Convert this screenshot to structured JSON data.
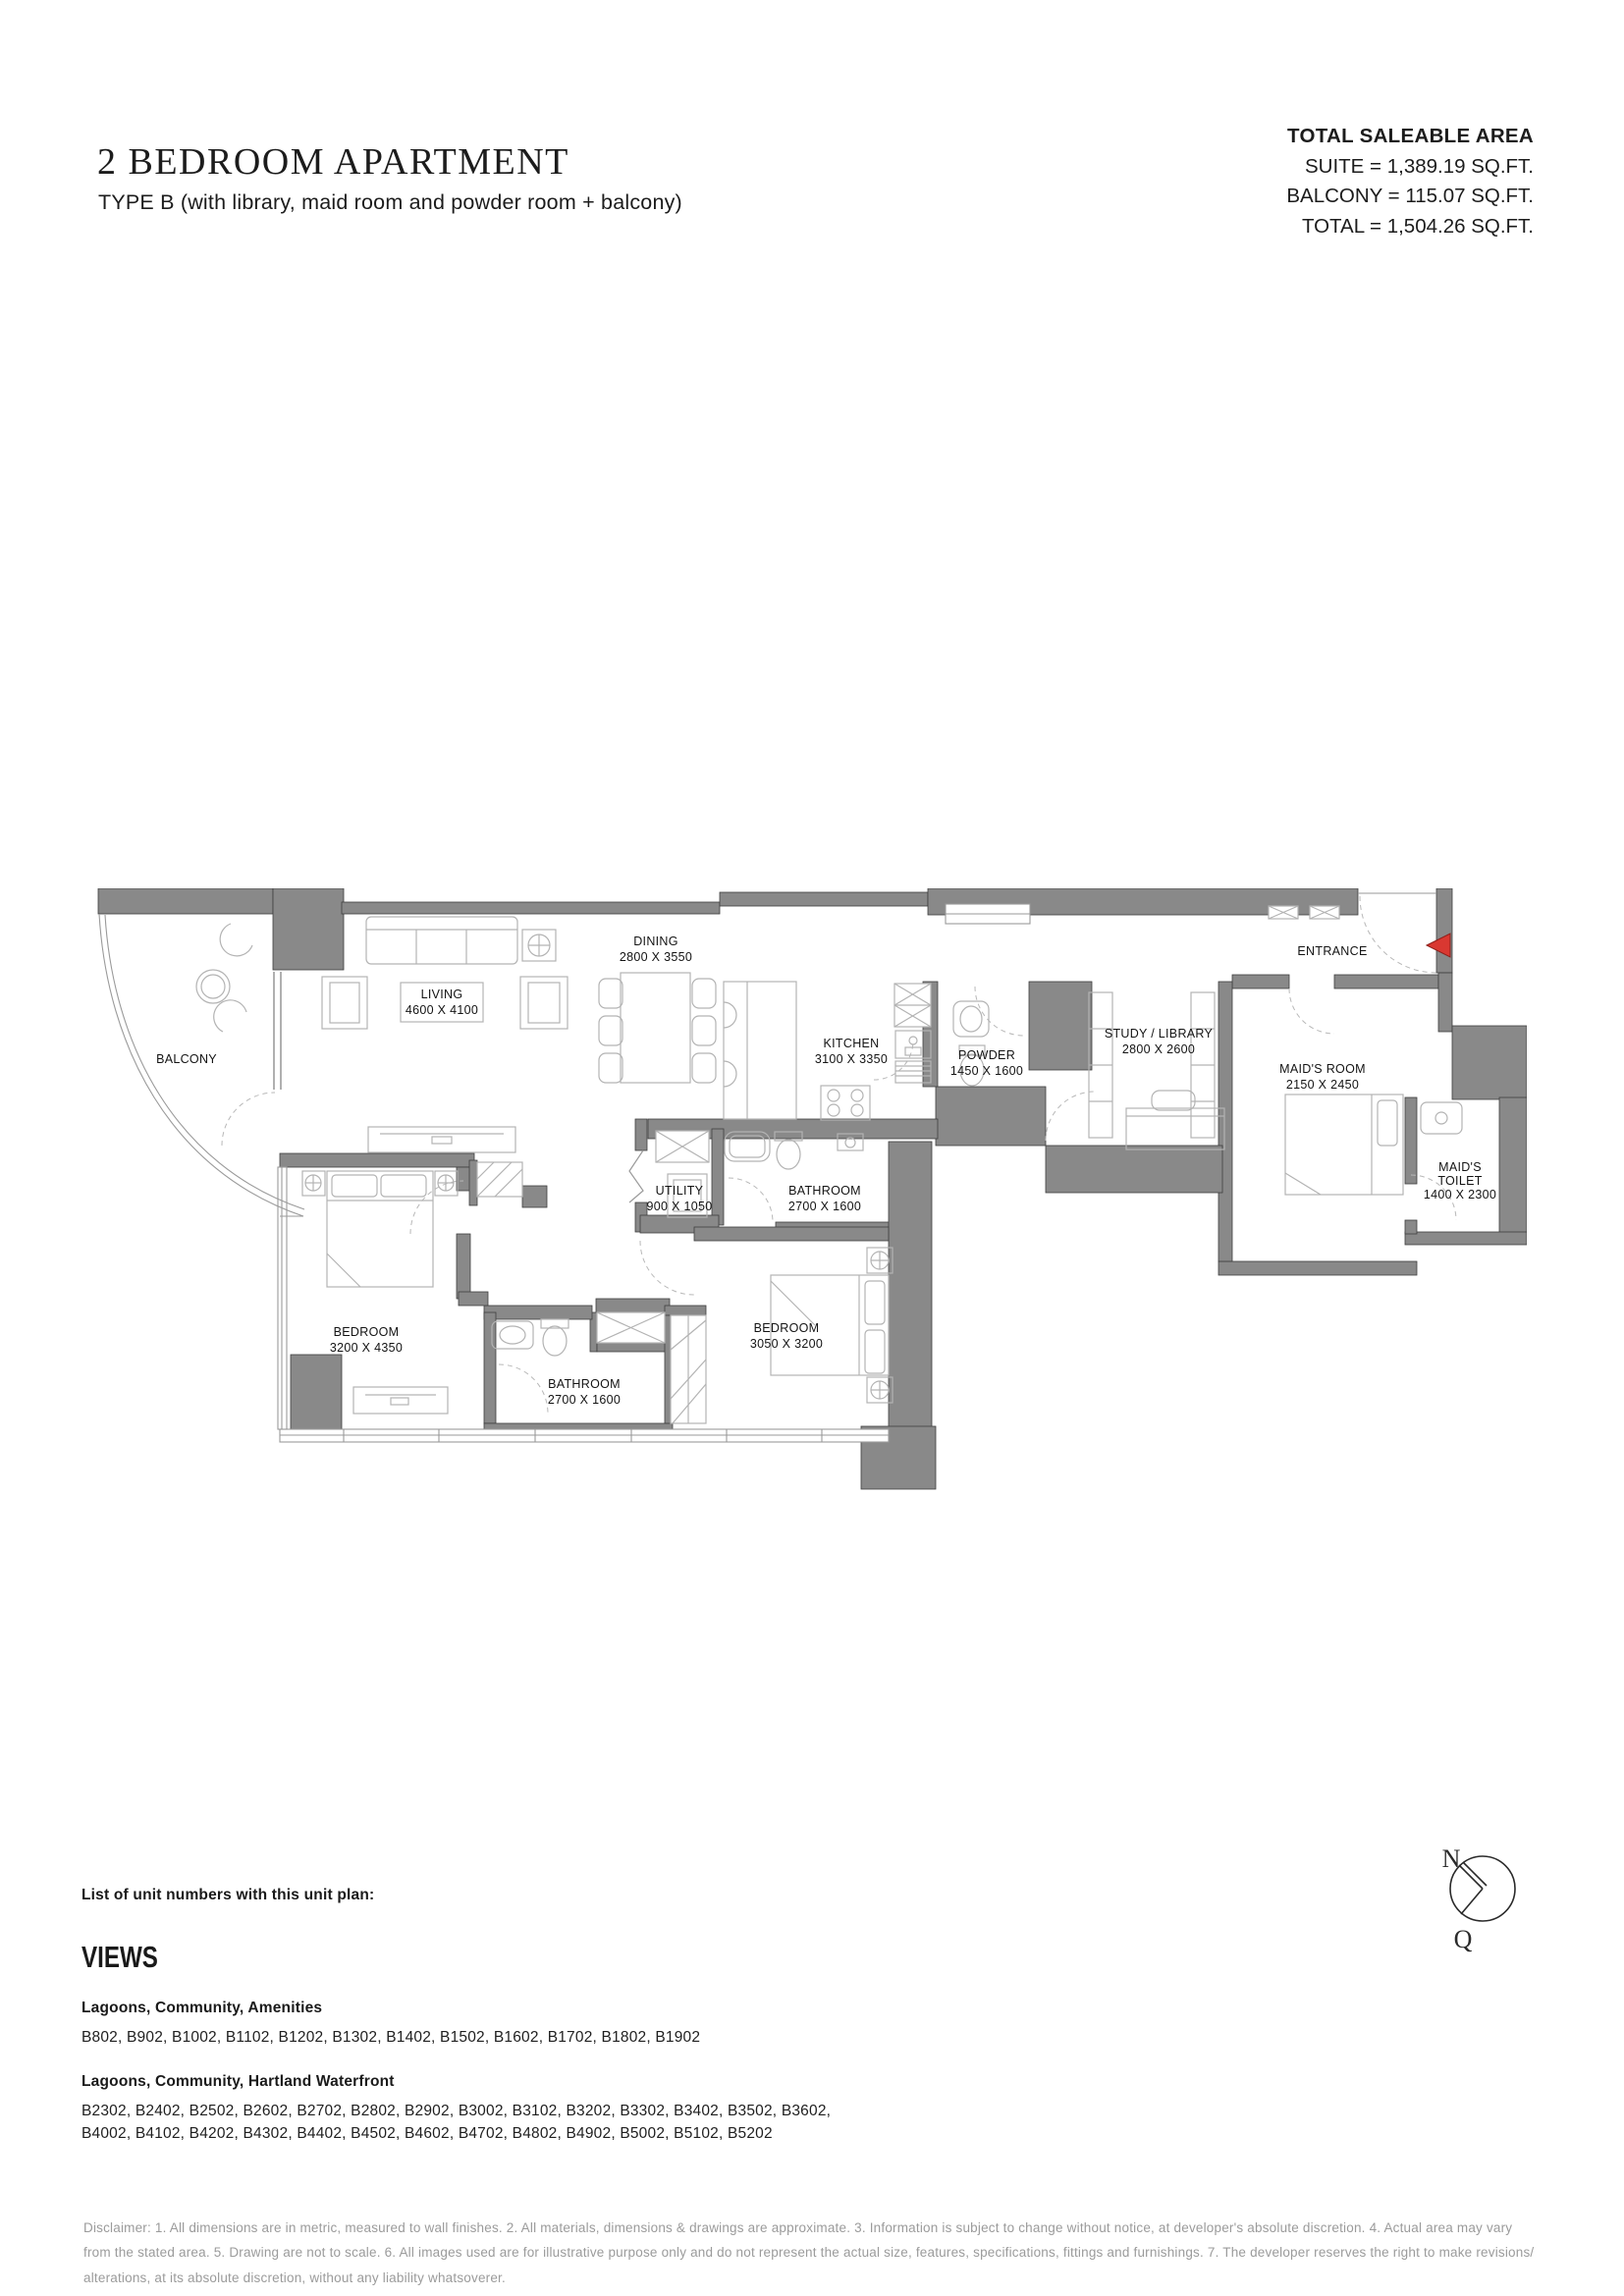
{
  "header": {
    "title": "2 BEDROOM APARTMENT",
    "subtitle": "TYPE B (with library, maid room and powder room + balcony)",
    "area": {
      "heading": "TOTAL SALEABLE AREA",
      "lines": [
        "SUITE = 1,389.19 SQ.FT.",
        "BALCONY = 115.07 SQ.FT.",
        "TOTAL = 1,504.26 SQ.FT."
      ]
    }
  },
  "plan": {
    "rooms": {
      "balcony": {
        "name": "BALCONY"
      },
      "living": {
        "name": "LIVING",
        "dims": "4600 X 4100"
      },
      "dining": {
        "name": "DINING",
        "dims": "2800 X 3550"
      },
      "kitchen": {
        "name": "KITCHEN",
        "dims": "3100 X 3350"
      },
      "powder": {
        "name": "POWDER",
        "dims": "1450 X 1600"
      },
      "study": {
        "name": "STUDY / LIBRARY",
        "dims": "2800 X 2600"
      },
      "entrance": {
        "name": "ENTRANCE"
      },
      "maids_room": {
        "name": "MAID'S ROOM",
        "dims": "2150 X 2450"
      },
      "maids_toilet": {
        "name1": "MAID'S",
        "name2": "TOILET",
        "dims": "1400 X 2300"
      },
      "utility": {
        "name": "UTILITY",
        "dims": "900 X 1050"
      },
      "bathroom1": {
        "name": "BATHROOM",
        "dims": "2700 X 1600"
      },
      "bedroom1": {
        "name": "BEDROOM",
        "dims": "3200 X 4350"
      },
      "bathroom2": {
        "name": "BATHROOM",
        "dims": "2700 X 1600"
      },
      "bedroom2": {
        "name": "BEDROOM",
        "dims": "3050 X 3200"
      }
    },
    "colors": {
      "wall": "#898989",
      "entrance_arrow": "#d93831"
    }
  },
  "units": {
    "intro": "List of unit numbers with this unit plan:",
    "views_heading": "VIEWS",
    "groups": [
      {
        "label": "Lagoons, Community, Amenities",
        "lines": [
          "B802, B902, B1002, B1102, B1202, B1302, B1402, B1502, B1602, B1702, B1802, B1902"
        ]
      },
      {
        "label": "Lagoons, Community, Hartland Waterfront",
        "lines": [
          "B2302, B2402, B2502, B2602, B2702, B2802, B2902, B3002, B3102, B3202, B3302, B3402, B3502, B3602,",
          "B4002, B4102, B4202, B4302, B4402, B4502, B4602, B4702, B4802, B4902, B5002, B5102, B5202"
        ]
      }
    ]
  },
  "compass": {
    "north_label": "N",
    "qibla_label": "Q"
  },
  "disclaimer": "Disclaimer: 1. All dimensions are in metric, measured to wall finishes. 2. All materials, dimensions & drawings are approximate. 3. Information is subject to change without notice, at developer's absolute discretion. 4. Actual area may vary from the stated area. 5. Drawing are not to scale. 6. All images used are for illustrative purpose only and do not represent the actual size, features, specifications, fittings and furnishings. 7. The developer reserves the right to make revisions/ alterations, at its absolute discretion, without any liability whatsoverer."
}
